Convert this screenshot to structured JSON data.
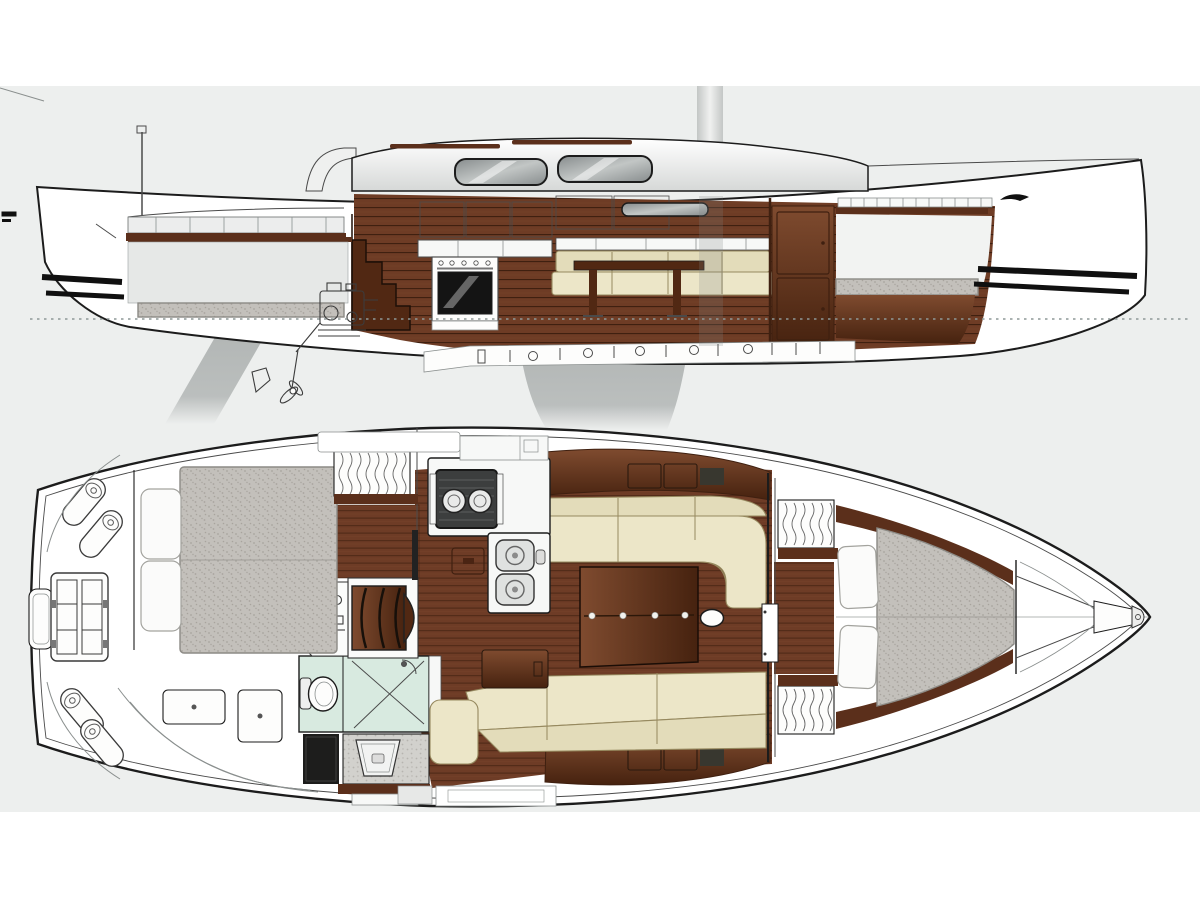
{
  "palette": {
    "page_bg": "#ffffff",
    "canvas_bg": "#edefee",
    "line": "#1c1c1c",
    "thin": "#4a4a4a",
    "faint": "#8a8f8e",
    "hull_white": "#ffffff",
    "deck_white": "#f7f8f7",
    "wood_dark": "#5b2f1b",
    "wood_mid": "#6e3c25",
    "wood_seam": "#3f2010",
    "wood_hi": "#7f4b2f",
    "wood_lo": "#46220f",
    "sole_base": "#6e3c26",
    "sole_seam": "#532c19",
    "steps_wood": "#512813",
    "cushion_cream": "#ece6c8",
    "cushion_cream2": "#e3dcba",
    "cushion_edge": "#96895f",
    "pillow_white": "#fbfbfa",
    "pillow_edge": "#a3a39e",
    "mattress_gray": "#c3c0bb",
    "mattress_dot": "#a8a49e",
    "mattress_edge": "#8c8a85",
    "mint": "#d8eae0",
    "speckle_light": "#d2d1cd",
    "speckle_light_dot": "#b6b4af",
    "metal": "#c6c9c8",
    "window_hi": "#c2c6c5",
    "window_lo": "#878c8d",
    "coach_hi": "#ffffff",
    "coach_lo": "#d6d8d7",
    "keel_gray": "#b2b6b5",
    "glass_black": "#141414",
    "stripe_black": "#101010",
    "waterline": "#8e9897",
    "engine_line": "#3c3c3c",
    "mast_edge": "#c3c6c5",
    "mast_mid": "#f0f1f0"
  },
  "diagram": {
    "type": "sailing-yacht-general-arrangement",
    "views": [
      {
        "id": "side-profile",
        "parts": [
          "hull",
          "transom",
          "keel",
          "rudder",
          "propeller",
          "saildrive-engine",
          "mast",
          "coachroof",
          "sprayhood",
          "coachroof-windows",
          "hull-window",
          "grab-rails",
          "slotted-toerail",
          "cockpit-bench",
          "cockpit-sole",
          "companionway-steps",
          "galley-counter",
          "oven",
          "overhead-lockers",
          "salon-settee",
          "salon-table",
          "forward-bulkhead",
          "forward-lockers",
          "forward-berth",
          "aft-berth",
          "keel-bolts",
          "hull-stripes-bow",
          "hull-stripes-stern",
          "waterline",
          "bow-logo",
          "rudder-stock",
          "stern-antenna"
        ]
      },
      {
        "id": "deck-plan",
        "parts": [
          "hull",
          "toerail-line",
          "anchor-locker",
          "bow-fitting",
          "v-berth-mattress",
          "v-berth-pillows",
          "hanging-lockers-forward",
          "forward-bulkhead-door",
          "cabin-sole",
          "salon-table",
          "mast-post",
          "port-u-settee",
          "starboard-settee",
          "storage-cabinets",
          "galley-counter",
          "gimbal-stove",
          "double-sink",
          "sole-hatch",
          "chart-seat",
          "chart-locker",
          "head-room",
          "toilet",
          "shower",
          "vanity-sink",
          "head-locker",
          "companionway-steps",
          "engine-compartment",
          "aft-berth-mattress",
          "aft-berth-pillows",
          "hanging-locker-aft",
          "aft-cabin-floor",
          "cockpit-table",
          "cockpit-lockers",
          "transom-locker",
          "fenders",
          "deck-panels"
        ]
      }
    ]
  }
}
